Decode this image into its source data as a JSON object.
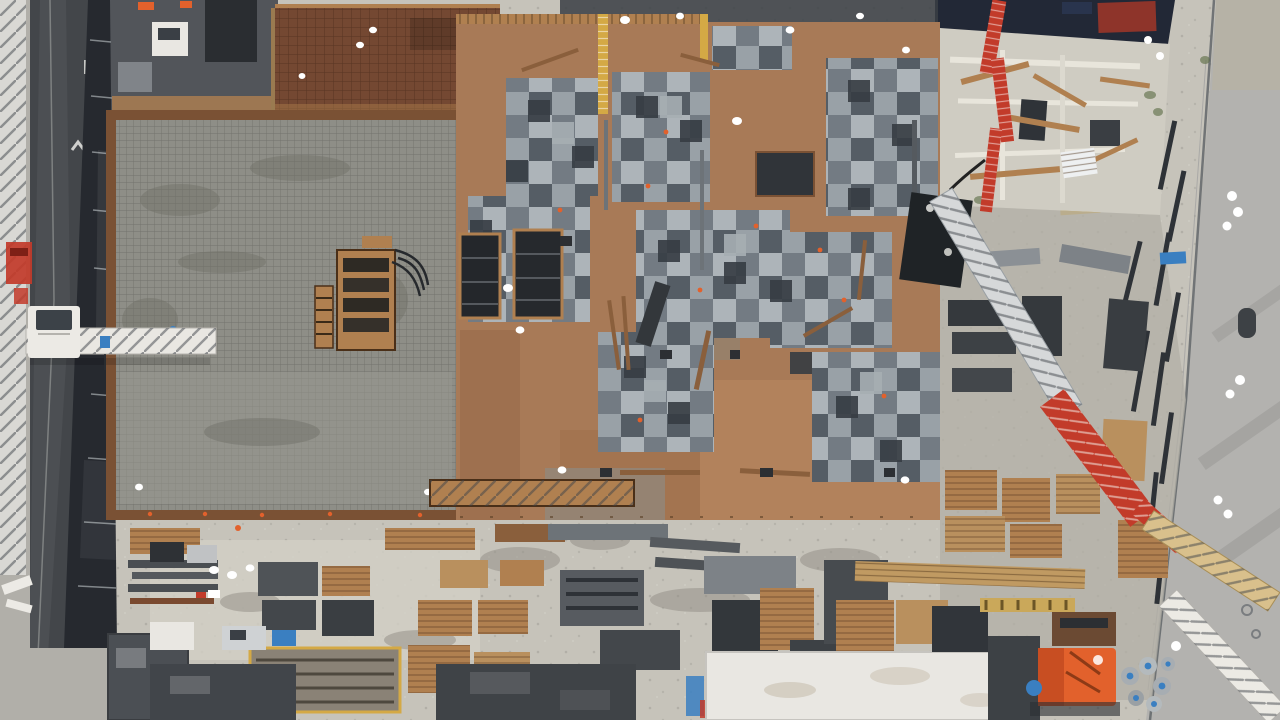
{
  "scene": {
    "type": "aerial-photo",
    "description": "Top-down drone photograph of an urban building construction site: a white tower crane over an asphalt road on the left, a large poured concrete slab with rebar mesh, plywood formwork decking with gray formwork-panel checkerboard patches, a concrete placing boom crossing diagonally, a material storage yard along a perimeter fence, and site containers, trucks and an orange pump machine along the bottom.",
    "colors": {
      "gravel": "#c6c3ba",
      "gravel_dark": "#b2afa5",
      "road_asphalt": "#43464a",
      "sidewalk": "#b1afa9",
      "crane_white": "#eceae5",
      "scaffold_dark": "#26292f",
      "slab_gray": "#8e8e87",
      "rust_deck": "#744832",
      "plywood": "#a87a57",
      "panel_light": "#a6aeb3",
      "panel_mid": "#6e767e",
      "panel_dark": "#363c43",
      "wood": "#b08050",
      "pump_red": "#c23b2a",
      "machine_orange": "#e2612c",
      "safety_yellow": "#d4a945",
      "tarp_navy": "#222836",
      "tarp_red": "#8e342a",
      "steel_dark": "#2e3237",
      "container_dark": "#45494e",
      "trailer_white": "#e9e7e2",
      "accent_blue": "#3a7fc1",
      "road_right": "#b3b2af",
      "concrete_white": "#cfccc2"
    },
    "labels": {
      "scene_root": "Aerial view of construction site",
      "tower_crane": "White tower crane mast",
      "crane_jib": "Tower crane jib over road",
      "crane_cab": "Crane operator cab",
      "access_road": "Asphalt road along left side",
      "scaffold_fence": "Scaffold screen between road and slab",
      "rebar_deck": "Rust-colored rebar deck awaiting pour",
      "concrete_slab": "Large gray concrete slab with rebar mesh",
      "slab_forms": "Wooden column forms on slab",
      "formwork_deck": "Plywood formwork deck",
      "formwork_panels": "Gray formwork panel checkerboard",
      "slab_openings": "Shaft openings in deck",
      "placing_boom": "Concrete placing boom (white lattice)",
      "pump_boom_red": "Red pump boom section",
      "lattice_boom_yellow": "Yellow lattice boom over road",
      "pump_machine": "Concrete pump unit",
      "upper_structure": "Exposed lower-level walls and lumber",
      "storage_yard": "Material storage yard",
      "perimeter_fence": "Perimeter fence line",
      "public_road": "Public road on right side",
      "tarp_covers": "Tarp-covered area",
      "site_offices": "Site containers and offices",
      "white_trailer": "White trailer roof",
      "orange_machine": "Orange site machine",
      "pipe_coils": "Stacked pipe coils",
      "flatbed_trailer": "Flatbed trailer with yellow frame",
      "material_stacks": "Formwork and pallet stacks",
      "workers": "Workers in white"
    }
  }
}
